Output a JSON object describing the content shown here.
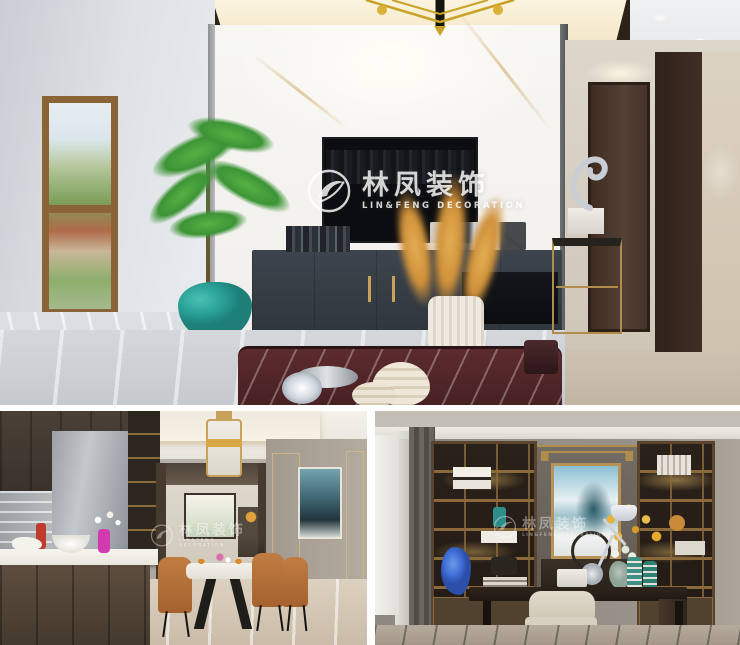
{
  "watermark": {
    "chinese": "林凤装饰",
    "english": "LIN&FENG DECORATION"
  },
  "photos": [
    {
      "id": "living-room",
      "label": "living room — marble TV wall, dark media cabinet, teal potted plant, pampas grass vase"
    },
    {
      "id": "kitchen-dining",
      "label": "open kitchen island and dining room with tan leather chairs and lantern pendant"
    },
    {
      "id": "study",
      "label": "study — built-in lit bookshelves, blue abstract painting, dark writing desk"
    }
  ],
  "palette": {
    "gold": "#c8a15a",
    "marble-white": "#f5f4f1",
    "cabinet-dark": "#3c434b",
    "teal-pot": "#2aa198",
    "pampas-gold": "#d0913a",
    "wood-brown": "#8a6436",
    "chair-tan": "#b5713c",
    "floor-beige": "#d8ccbd",
    "shelf-bronze": "#5a4430",
    "painting-blue": "#8cc0d4",
    "door-brown": "#3f2d21",
    "burgundy-marble": "#5c2b2e",
    "accent-blue-vase": "#3f6fd8"
  }
}
